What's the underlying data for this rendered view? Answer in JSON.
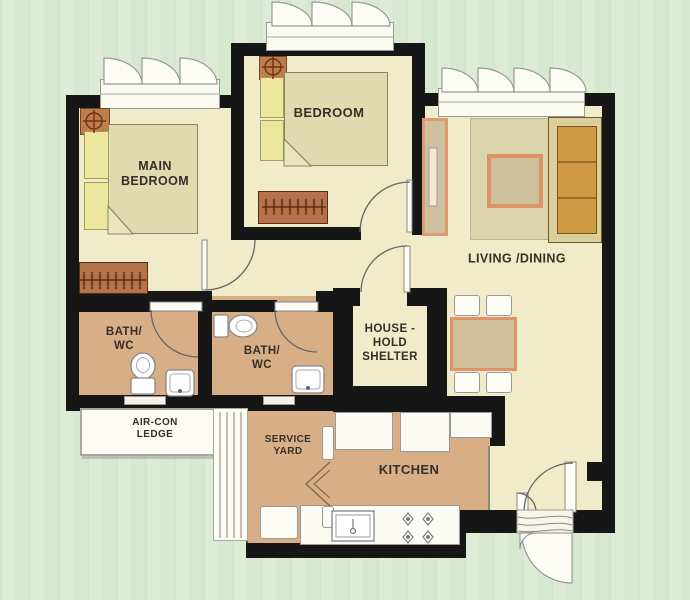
{
  "rooms": {
    "main_bedroom": {
      "label": "MAIN\nBEDROOM",
      "furniture": [
        "double-bed",
        "pillows",
        "bedside-table",
        "wardrobe",
        "casement-window"
      ]
    },
    "bedroom": {
      "label": "BEDROOM",
      "furniture": [
        "double-bed",
        "pillows",
        "bedside-table",
        "wardrobe",
        "casement-window"
      ]
    },
    "living_dining": {
      "label": "LIVING /DINING",
      "furniture": [
        "sofa",
        "rug",
        "coffee-table",
        "tv-console",
        "dining-table",
        "dining-chairs",
        "casement-window",
        "main-entrance-door"
      ]
    },
    "bath_1": {
      "label": "BATH/\nWC",
      "furniture": [
        "toilet",
        "wash-basin",
        "swing-door"
      ]
    },
    "bath_2": {
      "label": "BATH/\nWC",
      "furniture": [
        "toilet",
        "wash-basin",
        "swing-door"
      ]
    },
    "household_shelter": {
      "label": "HOUSE -\nHOLD\nSHELTER",
      "furniture": [
        "blast-door"
      ]
    },
    "aircon_ledge": {
      "label": "AIR-CON\nLEDGE",
      "furniture": [
        "grille"
      ]
    },
    "service_yard": {
      "label": "SERVICE\nYARD",
      "furniture": [
        "washing-machine",
        "bifold-door"
      ]
    },
    "kitchen": {
      "label": "KITCHEN",
      "furniture": [
        "kitchen-sink",
        "cooker-hob",
        "counters"
      ]
    }
  },
  "colors": {
    "background_green": "#d8e9d1",
    "floor_cream": "#f0ecca",
    "wet_area_tan": "#d7ae85",
    "wall_black": "#161616",
    "table_border_orange": "#de9366",
    "wood_brown": "#b5724a",
    "pillow_yellow": "#ece79c",
    "sofa_gold": "#cf9a43",
    "fixture_white": "#fdfdf5"
  }
}
